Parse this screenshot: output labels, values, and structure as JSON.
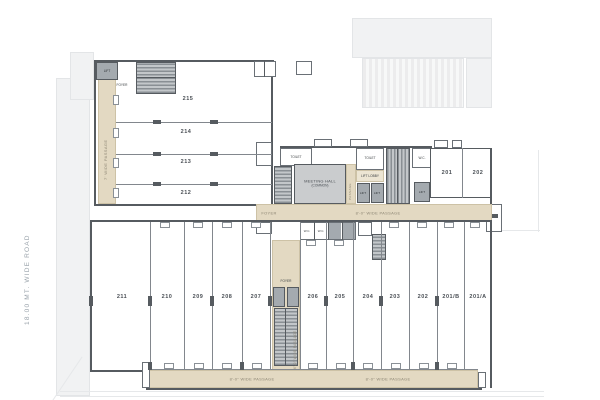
{
  "road": {
    "label": "18.00 MT. WIDE ROAD"
  },
  "passages": {
    "left": "7' WIDE PASSAGE",
    "mid": "8'-0\" WIDE PASSAGE",
    "bottom_left": "8'-0\" WIDE PASSAGE",
    "bottom_right": "8'-0\" WIDE PASSAGE",
    "central": "6'-0\" WIDE PASSAGE"
  },
  "foyers": {
    "upper": "FOYER",
    "mid": "FOYER",
    "lower": "FOYER"
  },
  "units_upper": [
    "215",
    "214",
    "213",
    "212"
  ],
  "units_lower": [
    "211",
    "210",
    "209",
    "208",
    "207",
    "206",
    "205",
    "204",
    "203",
    "202",
    "201/B",
    "201/A"
  ],
  "units_right": [
    "201",
    "202"
  ],
  "core": {
    "hall_line1": "MEETING HALL",
    "hall_line2": "(COMMON)",
    "toilet_a": "TOILET",
    "toilet_b": "TOILET",
    "wc": "W.C.",
    "wc_row": "W.C.",
    "lift_lobby": "LIFT LOBBY",
    "lift": "LIFT",
    "passage": "PASSAGE"
  },
  "colors": {
    "wall": "#565b60",
    "passage_fill": "#e3d9c2",
    "lift_fill": "#a4aaaf",
    "hall_fill": "#caccce",
    "context": "#f1f2f3"
  }
}
